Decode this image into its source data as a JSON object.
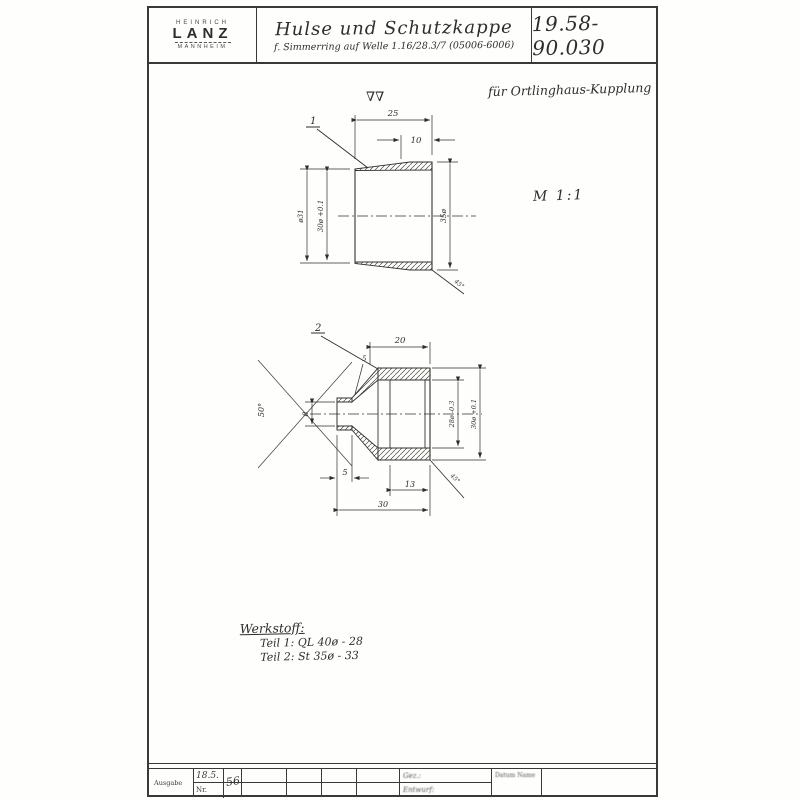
{
  "title_block": {
    "logo": {
      "line1": "HEINRICH",
      "line2": "LANZ",
      "line3": "MANNHEIM"
    },
    "title": "Hulse und Schutzkappe",
    "subtitle": "f. Simmerring auf Welle 1.16/28.3/7   (05006-6006)",
    "drawing_number": "19.58-90.030"
  },
  "annotations": {
    "top_right_note": "für Ortlinghaus-Kupplung",
    "scale_note": "M 1:1",
    "surface_symbol": "∇∇"
  },
  "drawing1": {
    "part_ref": "1",
    "dims": {
      "total": "25",
      "straight": "10",
      "outer_left": "ø31",
      "bore": "30ø +0.1",
      "outer_right": "35ø",
      "chamfer": "45°"
    }
  },
  "drawing2": {
    "part_ref": "2",
    "dims": {
      "top": "20",
      "wall": "5",
      "angle": "50°",
      "tip_bore": "8",
      "tip_len": "5",
      "depth": "13",
      "total": "30",
      "inner": "28ø -0.3",
      "outer": "30ø +0.1",
      "chamfer": "45°"
    }
  },
  "material_note": {
    "heading": "Werkstoff:",
    "line1": "Teil 1:  QL 40ø - 28",
    "line2": "Teil 2:  St 35ø - 33"
  },
  "footer": {
    "ausgabe_label": "Ausgabe",
    "date": "18.5.",
    "year": "56",
    "nr_label": "Nr.",
    "cell1_top": "Gez.:",
    "cell1_bottom": "Entwurf:",
    "cell2": "Datum   Name"
  }
}
